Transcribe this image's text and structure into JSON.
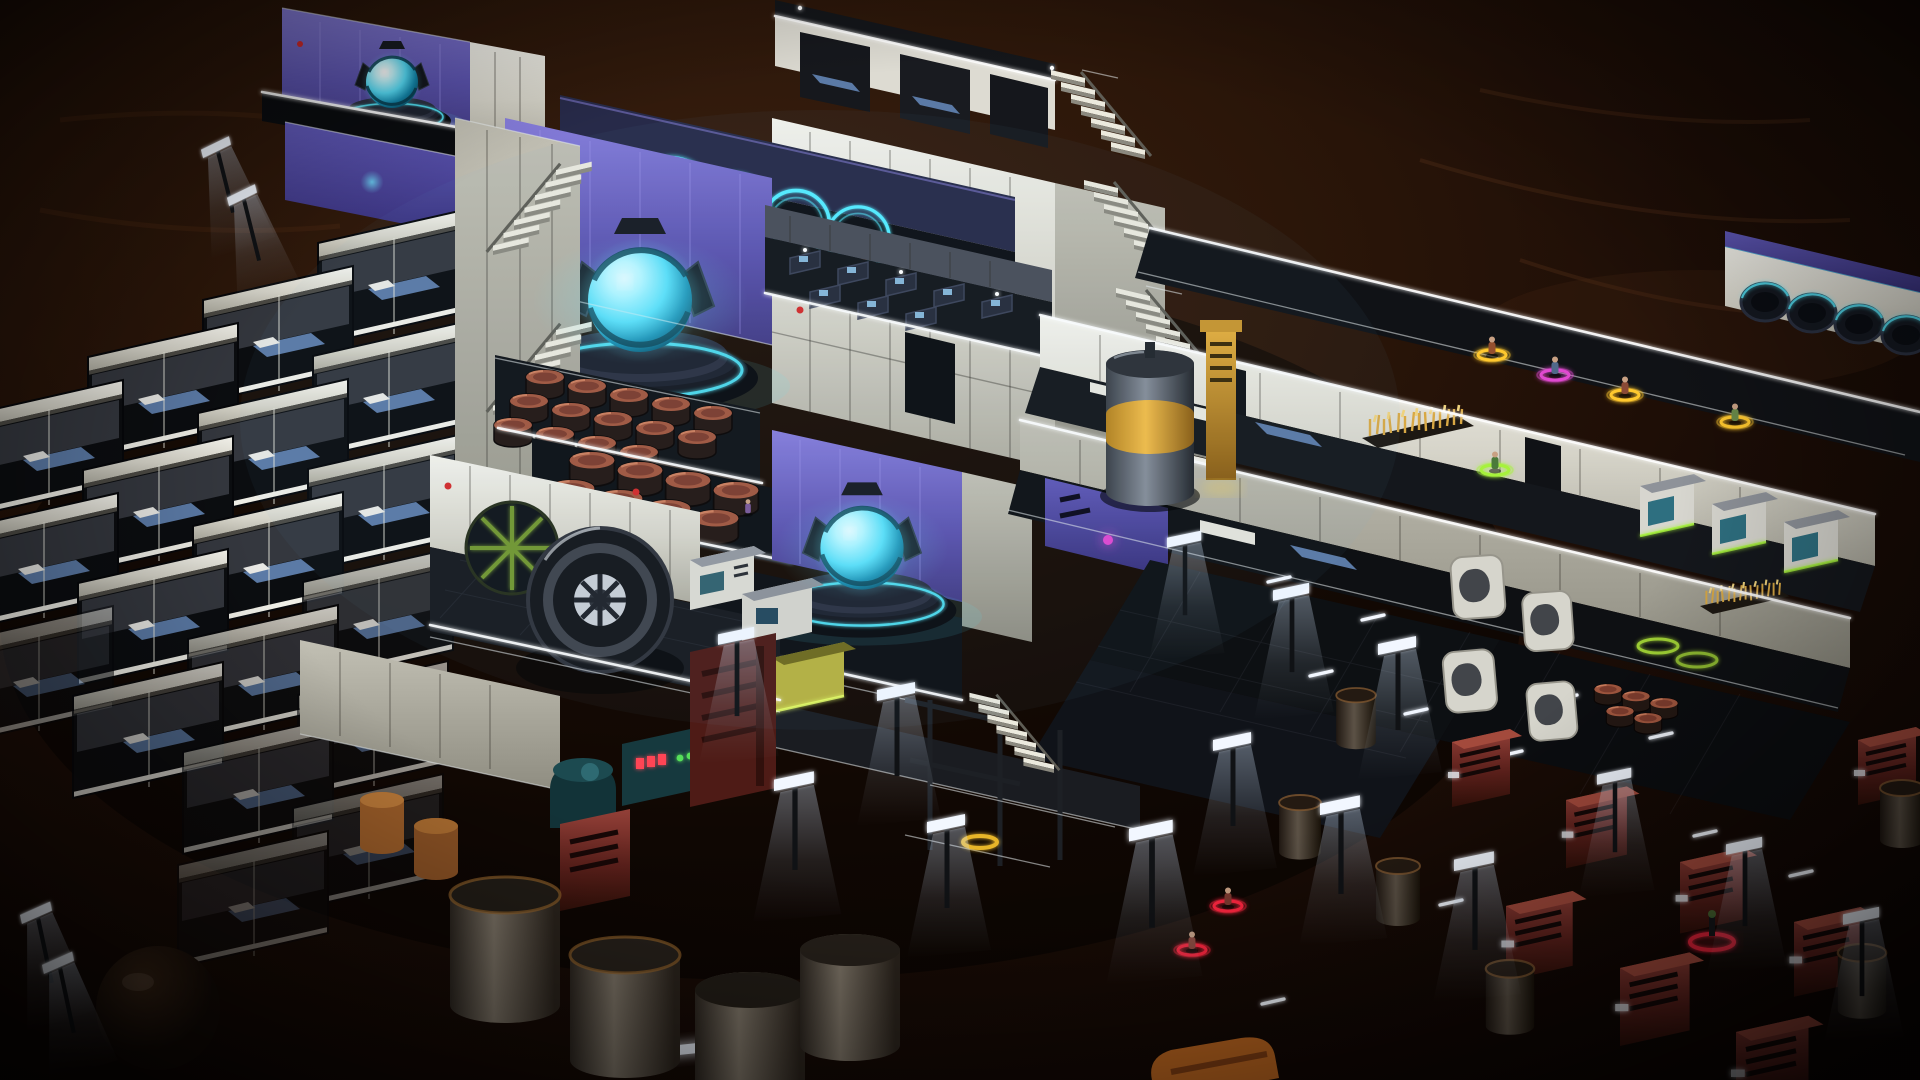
{
  "meta": {
    "domain": "game-screenshot",
    "view": "isometric cutaway colony base at night",
    "environment": "dark red-brown martian terrain",
    "ui_overlay": "none"
  },
  "palette": {
    "terrain_mid": "#2b1609",
    "neon_cyan": "#54ecff",
    "wheat_gold": "#d8a844",
    "ring_yellow": "#ffc82e",
    "ring_green": "#a6f23a",
    "ring_red": "#ff2840",
    "ring_magenta": "#e04ad0",
    "barrel_rust": "#a2573f",
    "silo_yellow": "#e2a62e",
    "lamp_white": "#eef4ff",
    "led_red": "#ff4455",
    "purple_wall": "#6f66c4",
    "wall_light": "#efeee7",
    "floor_dark": "#111418",
    "suit_orange": "#9a4f38"
  },
  "scene": {
    "structures": {
      "left_block": "stacked crew sleeping pods with lit bunks",
      "stair_tower": "white zigzag exterior staircases",
      "center_halls": "purple-lit generator halls with glowing fusion orbs",
      "dome_ring_room": "dark lounge with neon dome rings",
      "habitat_tower": "multi-storey tower with cutaway cabins and side stairs",
      "storage_rooms": "rust barrel stockpiles",
      "workshop": "turbine assembly machine with fabricators",
      "right_wing": "terraced wing with cabins, wheat planters, fabricators and hypersleep capsules",
      "yard": "dark landing yard with street lamps, airlock doors, red service units and fuel tanks"
    },
    "counts": {
      "fusion_generators": 3,
      "neon_dome_rings": 4,
      "hypersleep_capsules": 4,
      "wheat_planters": 2,
      "barrel_clusters": 2,
      "barrels_approx": 25,
      "red_service_units": 8,
      "fuel_tanks": 10,
      "street_lamps": 18,
      "airlock_door_panels": 4
    },
    "colonists": {
      "visible": 11,
      "selection_rings": {
        "yellow": 5,
        "red": 2,
        "green": 1,
        "magenta": 1
      },
      "empty_green_markers": 2,
      "red_ground_beacon": 1
    }
  }
}
